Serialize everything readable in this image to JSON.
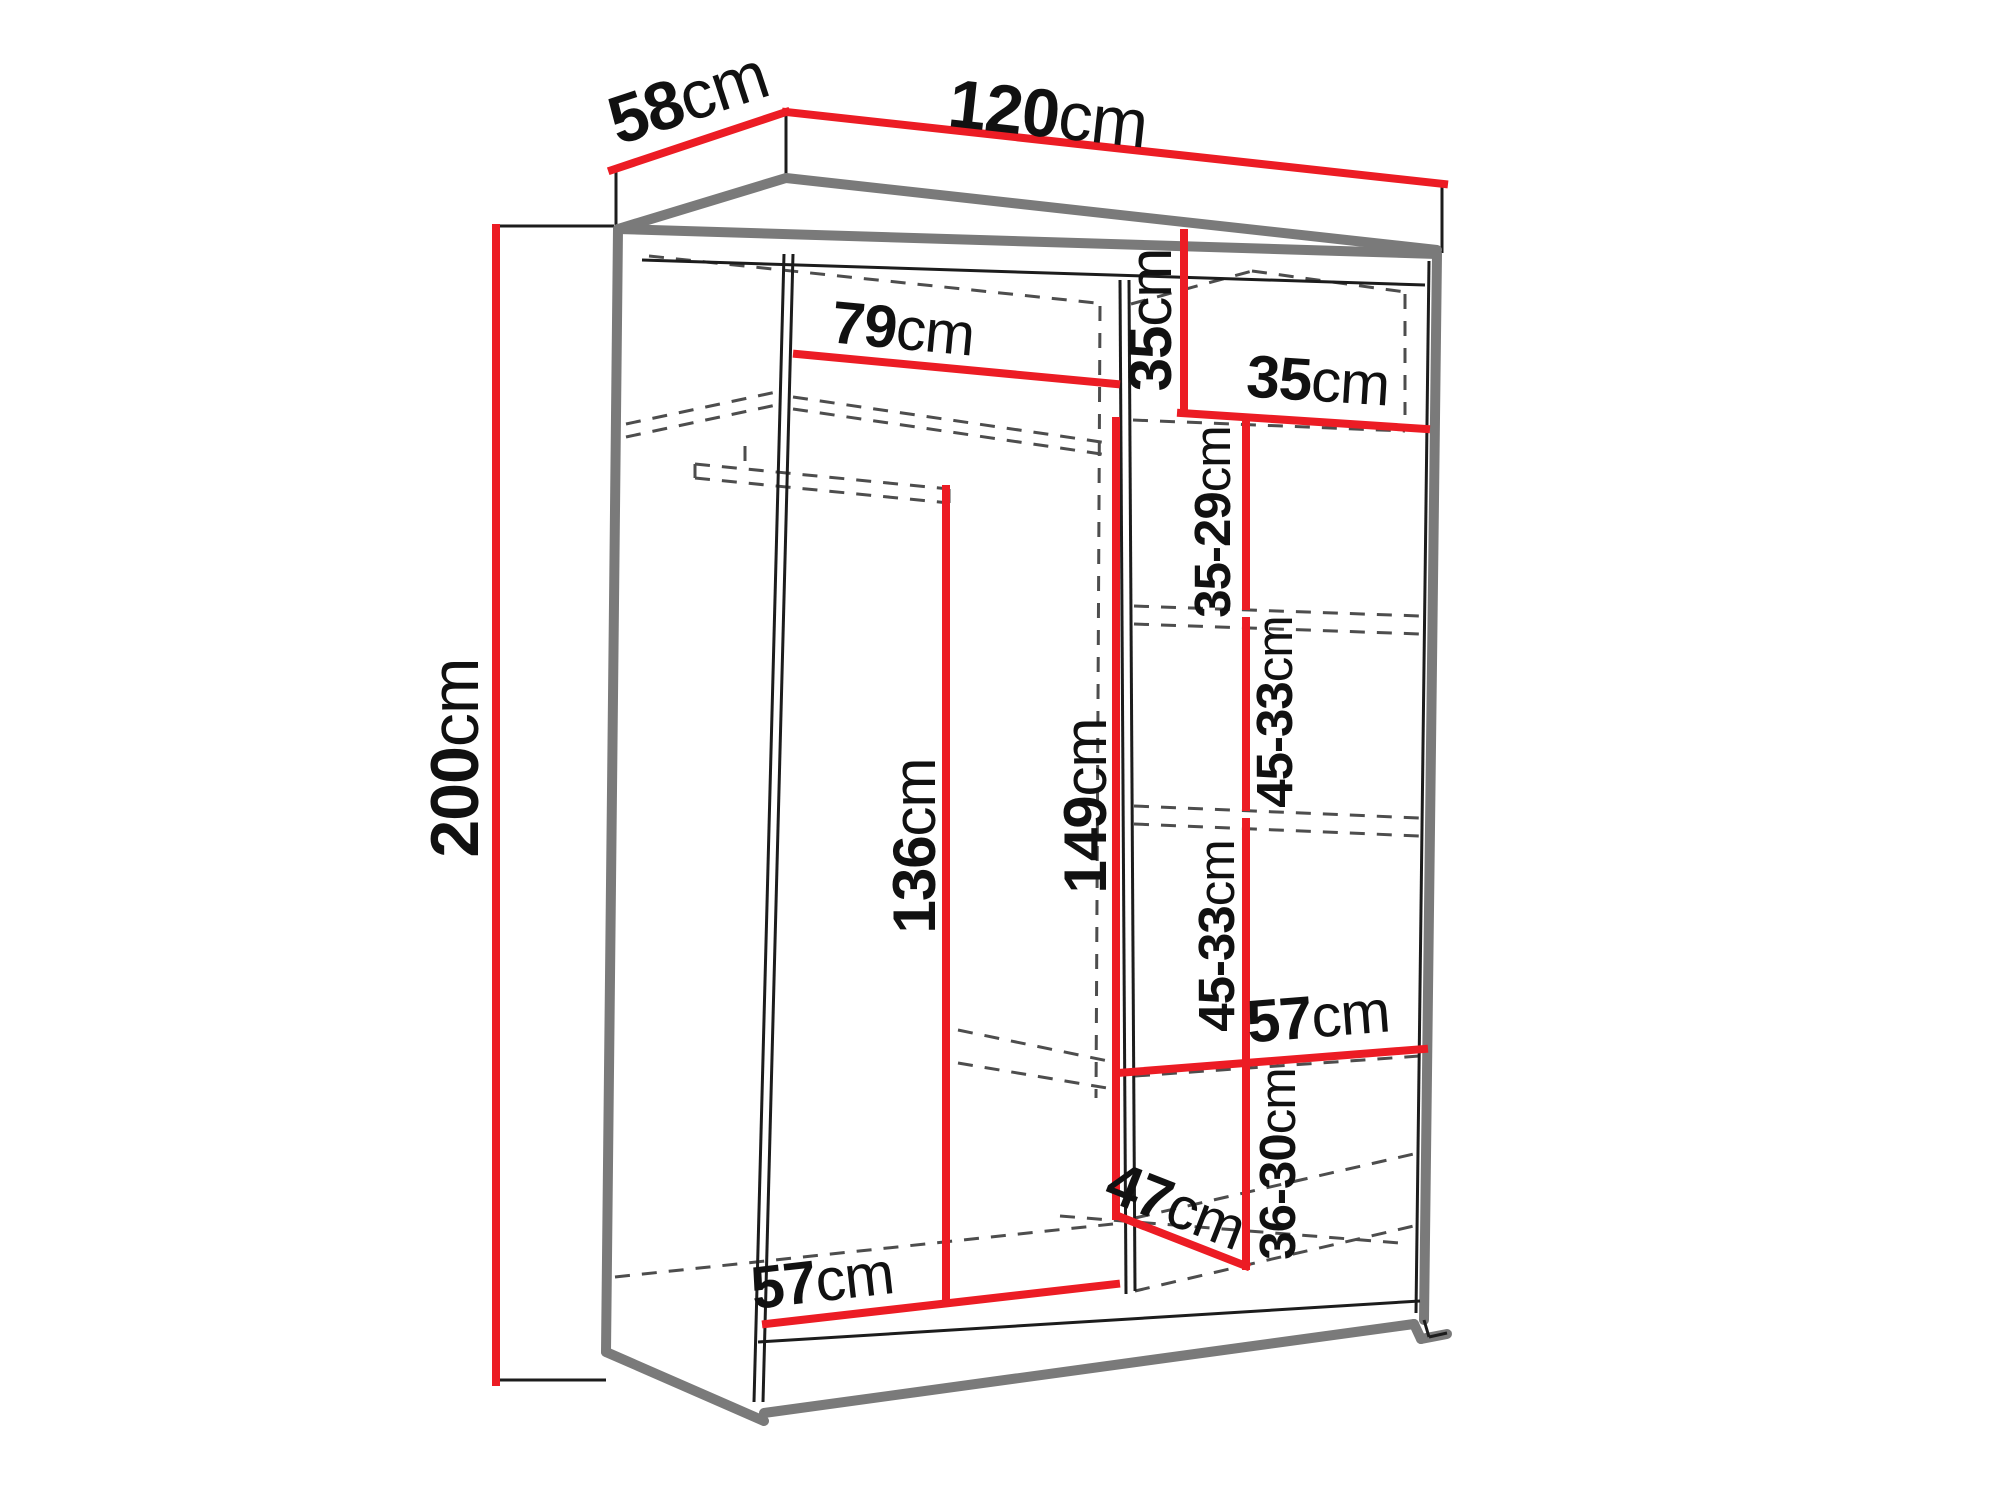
{
  "diagram": {
    "subject": "wardrobe-dimension-drawing",
    "unit": "cm"
  },
  "colors": {
    "dim-red": "#ec1c24",
    "carcass-gray": "#7a7a7a",
    "dash-gray": "#4d4d4d",
    "line-black": "#1c1c1c",
    "text-black": "#111111",
    "background": "#ffffff"
  },
  "dims": [
    {
      "id": "depth-top",
      "value": "58",
      "unit": "cm"
    },
    {
      "id": "width-top",
      "value": "120",
      "unit": "cm"
    },
    {
      "id": "height-left",
      "value": "200",
      "unit": "cm"
    },
    {
      "id": "left-section-width",
      "value": "79",
      "unit": "cm"
    },
    {
      "id": "top-right-height",
      "value": "35",
      "unit": "cm"
    },
    {
      "id": "top-right-width",
      "value": "35",
      "unit": "cm"
    },
    {
      "id": "shelf-gap-1",
      "value": "35-29",
      "unit": "cm"
    },
    {
      "id": "shelf-gap-2",
      "value": "45-33",
      "unit": "cm"
    },
    {
      "id": "shelf-gap-3",
      "value": "45-33",
      "unit": "cm"
    },
    {
      "id": "shelf-gap-4",
      "value": "36-30",
      "unit": "cm"
    },
    {
      "id": "right-shelf-width",
      "value": "57",
      "unit": "cm"
    },
    {
      "id": "left-section-height",
      "value": "136",
      "unit": "cm"
    },
    {
      "id": "mid-partition-height",
      "value": "149",
      "unit": "cm"
    },
    {
      "id": "bottom-right-depth",
      "value": "47",
      "unit": "cm"
    },
    {
      "id": "bottom-left-width",
      "value": "57",
      "unit": "cm"
    }
  ]
}
